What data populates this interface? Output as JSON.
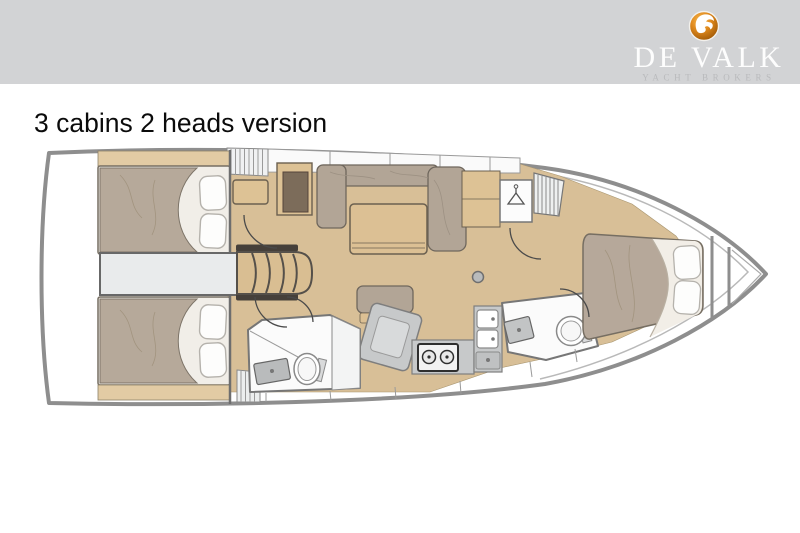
{
  "header": {
    "brand": "DE VALK",
    "tagline": "YACHT BROKERS",
    "logo": "falcon-logo",
    "colors": {
      "bar": "#d2d3d5",
      "brand_text": "#fdfdfd",
      "tagline_text": "#babbbd",
      "logo_orange": "#d8competent"
    }
  },
  "page": {
    "title": "3 cabins 2 heads version"
  },
  "floorplan": {
    "type": "yacht-interior-layout",
    "orientation": "bow-right",
    "cabins": 3,
    "heads": 2,
    "areas": [
      "aft cabin port",
      "aft cabin starboard",
      "engine compartment",
      "companionway steps",
      "nav station with chart table",
      "saloon settee",
      "saloon table",
      "ottoman",
      "galley with stove and double sink",
      "aft head with toilet and shower",
      "forward head with toilet",
      "hanging locker",
      "louvered locker",
      "forward cabin double bed",
      "anchor locker"
    ],
    "colors": {
      "hull_outline": "#8e8e8e",
      "wood_floor": "#d8bf97",
      "wood_furniture": "#ddc295",
      "mattress": "#b6a89a",
      "cushion": "#b2a596",
      "counter": "#c7c9ca",
      "room_fill": "#fbfbfb",
      "engine_strip": "#e9ebec",
      "pillow": "#fdfdfc",
      "dark_wood": "#7c6c5a"
    }
  }
}
